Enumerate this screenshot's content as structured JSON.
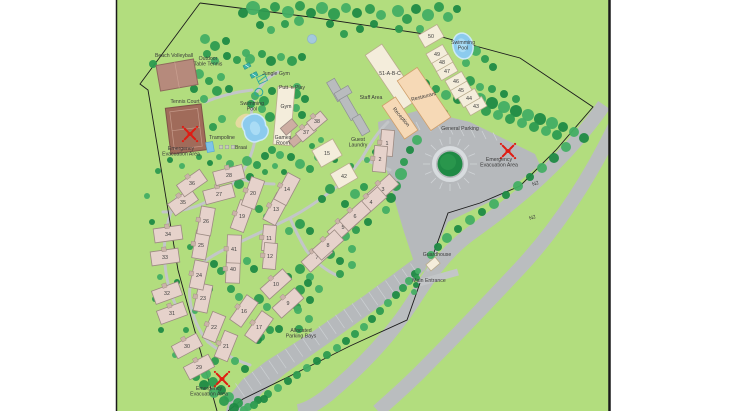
{
  "colors": {
    "ground": "#b2dd7e",
    "tree_dark": "#1f8a45",
    "tree_mid": "#2d9b50",
    "tree_light": "#43ae64",
    "road": "#c3c6c8",
    "parking": "#b6b9bc",
    "n2_road": "#babdbf",
    "unit_fill": "#e6d2cb",
    "unit_stroke": "#9d8b83",
    "unit_door": "#cbb3a9",
    "cream_fill": "#f4eddb",
    "cream_stroke": "#b9ac8d",
    "peach_fill": "#f6d9b6",
    "peach_stroke": "#cf9f6a",
    "staff_fill": "#b9bcbe",
    "staff_stroke": "#8f9294",
    "court_fill": "#a06b5a",
    "court_stroke": "#7e5347",
    "court_line": "#c59a8a",
    "volleyball_fill": "#b68a7c",
    "volleyball_stroke": "#8f685c",
    "pool_fill": "#8ccbee",
    "pool_edge": "#cdeaf8",
    "pool_highlight": "#aadcf5",
    "pond_fill": "#a4c9dd",
    "pond_stroke": "#8fb6ca",
    "emergency_red": "#e01b12",
    "teal": "#2aa89e",
    "sand": "#ead9a4",
    "boundary": "#1c1c1c",
    "label_text": "#3a3a3a"
  },
  "labels": [
    {
      "id": "beach-volleyball",
      "lines": [
        "Beach Volleyball"
      ],
      "x": 174,
      "y": 57,
      "rot": 0
    },
    {
      "id": "outdoor-table-tennis",
      "lines": [
        "Outdoor",
        "Table Tennis"
      ],
      "x": 208,
      "y": 60,
      "rot": 0
    },
    {
      "id": "jungle-gym",
      "lines": [
        "Jungle Gym"
      ],
      "x": 276,
      "y": 75,
      "rot": 0
    },
    {
      "id": "putt-n-play",
      "lines": [
        "Putt 'n Play"
      ],
      "x": 292,
      "y": 89,
      "rot": 0
    },
    {
      "id": "tennis-court",
      "lines": [
        "Tennis Court"
      ],
      "x": 185,
      "y": 103,
      "rot": 0
    },
    {
      "id": "swimming-pool-left",
      "lines": [
        "Swimming",
        "Pool"
      ],
      "x": 252,
      "y": 105,
      "rot": 0
    },
    {
      "id": "gym",
      "lines": [
        "Gym"
      ],
      "x": 286,
      "y": 108,
      "rot": 0
    },
    {
      "id": "games-room",
      "lines": [
        "Games",
        "Room"
      ],
      "x": 283,
      "y": 139,
      "rot": 0
    },
    {
      "id": "trampoline",
      "lines": [
        "Trampoline"
      ],
      "x": 222,
      "y": 139,
      "rot": 0
    },
    {
      "id": "braai",
      "lines": [
        "Braai"
      ],
      "x": 241,
      "y": 149,
      "rot": 0
    },
    {
      "id": "evac-tennis",
      "lines": [
        "Emergency",
        "Evacuation Area"
      ],
      "x": 181,
      "y": 150,
      "rot": 0
    },
    {
      "id": "staff-area",
      "lines": [
        "Staff Area"
      ],
      "x": 371,
      "y": 99,
      "rot": 0
    },
    {
      "id": "block-51",
      "lines": [
        "51-A-B-C"
      ],
      "x": 390,
      "y": 75,
      "rot": 0
    },
    {
      "id": "restaurant",
      "lines": [
        "Restaurant"
      ],
      "x": 424,
      "y": 98,
      "rot": -14
    },
    {
      "id": "reception",
      "lines": [
        "Reception"
      ],
      "x": 400,
      "y": 118,
      "rot": 50
    },
    {
      "id": "guest-laundry",
      "lines": [
        "Guest",
        "Laundry"
      ],
      "x": 358,
      "y": 141,
      "rot": 0
    },
    {
      "id": "swimming-pool-right",
      "lines": [
        "Swimming",
        "Pool"
      ],
      "x": 463,
      "y": 44,
      "rot": 0
    },
    {
      "id": "general-parking",
      "lines": [
        "General Parking"
      ],
      "x": 460,
      "y": 130,
      "rot": 0
    },
    {
      "id": "evac-parking",
      "lines": [
        "Emergency",
        "Evacuation Area"
      ],
      "x": 499,
      "y": 161,
      "rot": 0
    },
    {
      "id": "n2-upper",
      "lines": [
        "N2"
      ],
      "x": 536,
      "y": 185,
      "rot": -20
    },
    {
      "id": "n2-lower",
      "lines": [
        "N2"
      ],
      "x": 533,
      "y": 219,
      "rot": -20
    },
    {
      "id": "guardhouse",
      "lines": [
        "Guardhouse"
      ],
      "x": 437,
      "y": 256,
      "rot": 0
    },
    {
      "id": "main-entrance",
      "lines": [
        "Main Entrance"
      ],
      "x": 429,
      "y": 282,
      "rot": 0
    },
    {
      "id": "allocated-parking",
      "lines": [
        "Allocated",
        "Parking Bays"
      ],
      "x": 301,
      "y": 332,
      "rot": 0
    },
    {
      "id": "evac-south",
      "lines": [
        "Emergency",
        "Evacuation Area"
      ],
      "x": 209,
      "y": 390,
      "rot": 0
    }
  ],
  "buildings": [
    {
      "n": "1",
      "x": 387,
      "y": 143,
      "w": 26,
      "h": 13,
      "r": -85,
      "type": "unit"
    },
    {
      "n": "2",
      "x": 380,
      "y": 159,
      "w": 26,
      "h": 13,
      "r": -85,
      "type": "unit"
    },
    {
      "n": "3",
      "x": 383,
      "y": 189,
      "w": 30,
      "h": 14,
      "r": -42,
      "type": "unit"
    },
    {
      "n": "4",
      "x": 371,
      "y": 202,
      "w": 30,
      "h": 14,
      "r": -42,
      "type": "unit"
    },
    {
      "n": "5",
      "x": 343,
      "y": 227,
      "w": 30,
      "h": 14,
      "r": -42,
      "type": "unit"
    },
    {
      "n": "6",
      "x": 355,
      "y": 216,
      "w": 30,
      "h": 14,
      "r": -42,
      "type": "unit"
    },
    {
      "n": "7",
      "x": 317,
      "y": 257,
      "w": 30,
      "h": 14,
      "r": -42,
      "type": "unit"
    },
    {
      "n": "8",
      "x": 328,
      "y": 245,
      "w": 30,
      "h": 14,
      "r": -42,
      "type": "unit"
    },
    {
      "n": "9",
      "x": 288,
      "y": 303,
      "w": 30,
      "h": 14,
      "r": -42,
      "type": "unit"
    },
    {
      "n": "10",
      "x": 276,
      "y": 284,
      "w": 30,
      "h": 14,
      "r": -42,
      "type": "unit"
    },
    {
      "n": "11",
      "x": 269,
      "y": 238,
      "w": 26,
      "h": 13,
      "r": -85,
      "type": "unit"
    },
    {
      "n": "12",
      "x": 270,
      "y": 256,
      "w": 26,
      "h": 13,
      "r": -85,
      "type": "unit"
    },
    {
      "n": "13",
      "x": 276,
      "y": 209,
      "w": 30,
      "h": 14,
      "r": -62,
      "type": "unit"
    },
    {
      "n": "14",
      "x": 287,
      "y": 189,
      "w": 30,
      "h": 14,
      "r": -62,
      "type": "unit"
    },
    {
      "n": "15",
      "x": 327,
      "y": 153,
      "w": 24,
      "h": 19,
      "r": -30,
      "type": "cream"
    },
    {
      "n": "16",
      "x": 244,
      "y": 311,
      "w": 30,
      "h": 14,
      "r": -55,
      "type": "unit"
    },
    {
      "n": "17",
      "x": 259,
      "y": 327,
      "w": 30,
      "h": 14,
      "r": -55,
      "type": "unit"
    },
    {
      "n": "19",
      "x": 242,
      "y": 216,
      "w": 30,
      "h": 14,
      "r": -70,
      "type": "unit"
    },
    {
      "n": "20",
      "x": 253,
      "y": 193,
      "w": 30,
      "h": 14,
      "r": -70,
      "type": "unit"
    },
    {
      "n": "21",
      "x": 226,
      "y": 346,
      "w": 28,
      "h": 14,
      "r": -68,
      "type": "unit"
    },
    {
      "n": "22",
      "x": 214,
      "y": 327,
      "w": 28,
      "h": 14,
      "r": -68,
      "type": "unit"
    },
    {
      "n": "23",
      "x": 203,
      "y": 298,
      "w": 28,
      "h": 14,
      "r": -78,
      "type": "unit"
    },
    {
      "n": "24",
      "x": 199,
      "y": 275,
      "w": 28,
      "h": 14,
      "r": -78,
      "type": "unit"
    },
    {
      "n": "25",
      "x": 201,
      "y": 245,
      "w": 28,
      "h": 14,
      "r": -80,
      "type": "unit"
    },
    {
      "n": "26",
      "x": 206,
      "y": 221,
      "w": 28,
      "h": 14,
      "r": -80,
      "type": "unit"
    },
    {
      "n": "27",
      "x": 219,
      "y": 194,
      "w": 30,
      "h": 14,
      "r": -15,
      "type": "unit"
    },
    {
      "n": "28",
      "x": 229,
      "y": 175,
      "w": 30,
      "h": 14,
      "r": -15,
      "type": "unit"
    },
    {
      "n": "29",
      "x": 199,
      "y": 367,
      "w": 28,
      "h": 14,
      "r": -28,
      "type": "unit"
    },
    {
      "n": "30",
      "x": 187,
      "y": 346,
      "w": 28,
      "h": 14,
      "r": -28,
      "type": "unit"
    },
    {
      "n": "31",
      "x": 172,
      "y": 313,
      "w": 28,
      "h": 14,
      "r": -20,
      "type": "unit"
    },
    {
      "n": "32",
      "x": 167,
      "y": 293,
      "w": 28,
      "h": 14,
      "r": -20,
      "type": "unit"
    },
    {
      "n": "33",
      "x": 165,
      "y": 257,
      "w": 28,
      "h": 14,
      "r": -8,
      "type": "unit"
    },
    {
      "n": "34",
      "x": 168,
      "y": 234,
      "w": 28,
      "h": 14,
      "r": -8,
      "type": "unit"
    },
    {
      "n": "35",
      "x": 183,
      "y": 202,
      "w": 28,
      "h": 14,
      "r": -35,
      "type": "unit"
    },
    {
      "n": "36",
      "x": 192,
      "y": 183,
      "w": 28,
      "h": 14,
      "r": -35,
      "type": "unit"
    },
    {
      "n": "37",
      "x": 306,
      "y": 132,
      "w": 18,
      "h": 11,
      "r": -40,
      "type": "unit"
    },
    {
      "n": "38",
      "x": 317,
      "y": 121,
      "w": 18,
      "h": 11,
      "r": -40,
      "type": "unit"
    },
    {
      "n": "40",
      "x": 233,
      "y": 269,
      "w": 28,
      "h": 14,
      "r": -88,
      "type": "unit"
    },
    {
      "n": "41",
      "x": 234,
      "y": 249,
      "w": 28,
      "h": 14,
      "r": -88,
      "type": "unit"
    },
    {
      "n": "42",
      "x": 344,
      "y": 176,
      "w": 22,
      "h": 17,
      "r": -30,
      "type": "cream"
    },
    {
      "n": "43",
      "x": 476,
      "y": 106,
      "w": 19,
      "h": 11,
      "r": -30,
      "type": "cream"
    },
    {
      "n": "44",
      "x": 469,
      "y": 98,
      "w": 19,
      "h": 11,
      "r": -30,
      "type": "cream"
    },
    {
      "n": "45",
      "x": 461,
      "y": 90,
      "w": 19,
      "h": 11,
      "r": -30,
      "type": "cream"
    },
    {
      "n": "46",
      "x": 456,
      "y": 81,
      "w": 19,
      "h": 11,
      "r": -30,
      "type": "cream"
    },
    {
      "n": "47",
      "x": 447,
      "y": 71,
      "w": 19,
      "h": 11,
      "r": -30,
      "type": "cream"
    },
    {
      "n": "48",
      "x": 442,
      "y": 62,
      "w": 19,
      "h": 11,
      "r": -30,
      "type": "cream"
    },
    {
      "n": "49",
      "x": 437,
      "y": 54,
      "w": 19,
      "h": 11,
      "r": -30,
      "type": "cream"
    },
    {
      "n": "50",
      "x": 431,
      "y": 36,
      "w": 22,
      "h": 14,
      "r": -30,
      "type": "cream"
    }
  ],
  "icons": [
    {
      "name": "emergency-evacuation-icon",
      "x": 190,
      "y": 134
    },
    {
      "name": "emergency-evacuation-icon",
      "x": 508,
      "y": 151
    },
    {
      "name": "emergency-evacuation-icon",
      "x": 222,
      "y": 379
    },
    {
      "name": "trampoline-icon",
      "x": 210,
      "y": 147
    },
    {
      "name": "braai-icon",
      "x": 227,
      "y": 147
    },
    {
      "name": "jungle-gym-icon",
      "x": 262,
      "y": 79
    },
    {
      "name": "putt-n-play-icon",
      "x": 258,
      "y": 92
    },
    {
      "name": "table-tennis-icon",
      "x": 247,
      "y": 66
    },
    {
      "name": "table-tennis-icon",
      "x": 254,
      "y": 75
    }
  ]
}
